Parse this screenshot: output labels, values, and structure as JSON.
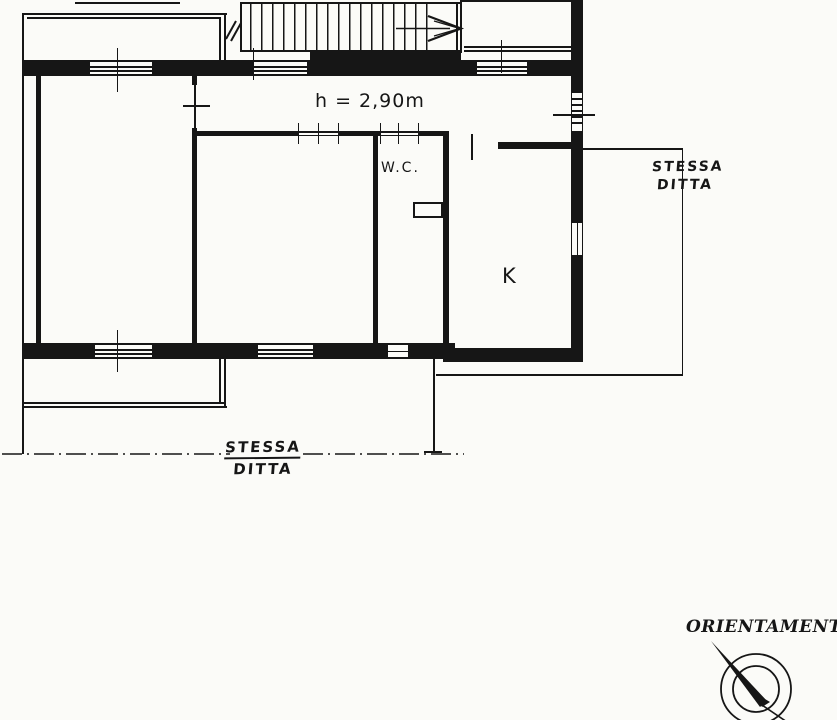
{
  "colors": {
    "ink": "#161616",
    "paper": "#fbfbf8"
  },
  "labels": {
    "ceiling_height": "h = 2,90m",
    "wc": "W.C.",
    "kitchen": "K",
    "right_boundary_line1": "STESSA",
    "right_boundary_line2": "DITTA",
    "bottom_boundary_line1": "STESSA",
    "bottom_boundary_line2": "DITTA",
    "orientation": "ORIENTAMENTO"
  }
}
